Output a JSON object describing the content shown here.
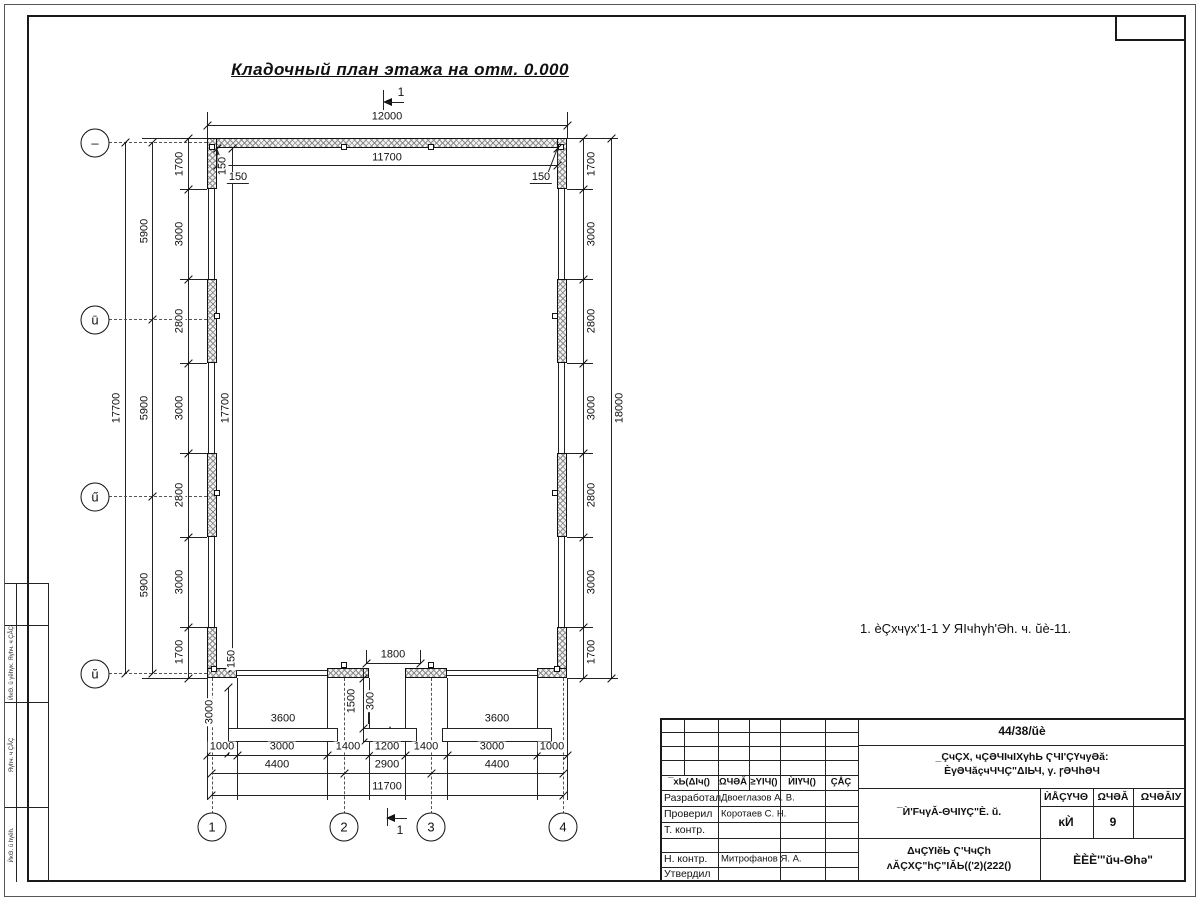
{
  "drawing_title": "Кладочный план этажа на отм. 0.000",
  "note": "1. èÇхчγх'1-1 У ЯIчhγh'Əh. ч. ŭè-11.",
  "section_mark_label": "1",
  "axes": {
    "left_labels": [
      "–",
      "ū",
      "ű",
      "ŭ"
    ],
    "bottom_labels": [
      "1",
      "2",
      "3",
      "4"
    ]
  },
  "dimensions": [
    {
      "t": "12000",
      "x": 387,
      "y": 117
    },
    {
      "t": "11700",
      "x": 387,
      "y": 158
    },
    {
      "t": "150",
      "x": 223,
      "y": 166,
      "r": 1
    },
    {
      "t": "150",
      "x": 238,
      "y": 178,
      "u": 1
    },
    {
      "t": "150",
      "x": 541,
      "y": 178,
      "u": 1
    },
    {
      "t": "1700",
      "x": 180,
      "y": 164,
      "r": 1
    },
    {
      "t": "3000",
      "x": 180,
      "y": 234,
      "r": 1
    },
    {
      "t": "2800",
      "x": 180,
      "y": 321,
      "r": 1
    },
    {
      "t": "3000",
      "x": 180,
      "y": 408,
      "r": 1
    },
    {
      "t": "2800",
      "x": 180,
      "y": 495,
      "r": 1
    },
    {
      "t": "3000",
      "x": 180,
      "y": 582,
      "r": 1
    },
    {
      "t": "1700",
      "x": 180,
      "y": 652,
      "r": 1
    },
    {
      "t": "5900",
      "x": 145,
      "y": 231,
      "r": 1
    },
    {
      "t": "5900",
      "x": 145,
      "y": 408,
      "r": 1
    },
    {
      "t": "5900",
      "x": 145,
      "y": 585,
      "r": 1
    },
    {
      "t": "17700",
      "x": 117,
      "y": 408,
      "r": 1
    },
    {
      "t": "17700",
      "x": 226,
      "y": 408,
      "r": 1
    },
    {
      "t": "1700",
      "x": 592,
      "y": 164,
      "r": 1
    },
    {
      "t": "3000",
      "x": 592,
      "y": 234,
      "r": 1
    },
    {
      "t": "2800",
      "x": 592,
      "y": 321,
      "r": 1
    },
    {
      "t": "3000",
      "x": 592,
      "y": 408,
      "r": 1
    },
    {
      "t": "2800",
      "x": 592,
      "y": 495,
      "r": 1
    },
    {
      "t": "3000",
      "x": 592,
      "y": 582,
      "r": 1
    },
    {
      "t": "1700",
      "x": 592,
      "y": 652,
      "r": 1
    },
    {
      "t": "18000",
      "x": 620,
      "y": 408,
      "r": 1
    },
    {
      "t": "1800",
      "x": 393,
      "y": 655
    },
    {
      "t": "1500",
      "x": 352,
      "y": 701,
      "r": 1
    },
    {
      "t": "300",
      "x": 371,
      "y": 701,
      "r": 1
    },
    {
      "t": "3600",
      "x": 283,
      "y": 719
    },
    {
      "t": "3600",
      "x": 497,
      "y": 719
    },
    {
      "t": "3000",
      "x": 210,
      "y": 712,
      "r": 1
    },
    {
      "t": "150",
      "x": 232,
      "y": 659,
      "r": 1
    },
    {
      "t": "1000",
      "x": 222,
      "y": 747
    },
    {
      "t": "3000",
      "x": 282,
      "y": 747
    },
    {
      "t": "1400",
      "x": 348,
      "y": 747
    },
    {
      "t": "1200",
      "x": 387,
      "y": 747
    },
    {
      "t": "1400",
      "x": 426,
      "y": 747
    },
    {
      "t": "3000",
      "x": 492,
      "y": 747
    },
    {
      "t": "1000",
      "x": 552,
      "y": 747
    },
    {
      "t": "4400",
      "x": 277,
      "y": 765
    },
    {
      "t": "2900",
      "x": 387,
      "y": 765
    },
    {
      "t": "4400",
      "x": 497,
      "y": 765
    },
    {
      "t": "11700",
      "x": 387,
      "y": 787
    }
  ],
  "title_block": {
    "doc_number": "44/38/ŭè",
    "project_name_line1": "_ÇчÇХ, чÇƏЧIчIХγhЬ ҀЧI'ÇҮчγƏă:",
    "project_name_line2": "ÈγƏЧăçчЧЧÇ\"ΔIЬЧ, γ. ꞅƏЧhƏЧ",
    "sheet_title": "¯Ѝ'FчγǍ-ΘЧIҮÇ\"È. ŭ.",
    "stage_header": "ЍÅÇҮЧΘ",
    "sheet_header": "ΩЧƏǍ",
    "sheets_header": "ΩЧƏǍIУ",
    "stage_value": "ĸЍ",
    "sheet_value": "9",
    "sheets_value": "",
    "org_line1": "ΔчÇҮIĕЬ Ҁ'ЧчÇh",
    "org_line2": "ʌǍÇХÇ\"hÇ\"IǍЬ(('2)(222()",
    "company": "ÈÈÈ'\"ŭч-Θhə\"",
    "header_cols": [
      "¯хЬ(ΔIч()",
      "ΩЧƏǍ",
      "≥YIЧ()",
      "ЍIҮЧ()",
      "ÇÅÇ"
    ],
    "roles": [
      {
        "role": "Разработал",
        "name": "Двоеглазов А. В."
      },
      {
        "role": "Проверил",
        "name": "Коротаев С. Н."
      },
      {
        "role": "Т. контр.",
        "name": ""
      },
      {
        "role": "",
        "name": ""
      },
      {
        "role": "Н. контр.",
        "name": "Митрофанов Я. А."
      },
      {
        "role": "Утвердил",
        "name": ""
      }
    ]
  },
  "margin_cells": [
    "ЍĸΘ. ŭ γĕhγĸ. Яγhч. ч ÇÅÇ",
    "Яγhч. ч ÇÅÇ",
    "ЍĸΘ. ŭ hγĕh."
  ]
}
